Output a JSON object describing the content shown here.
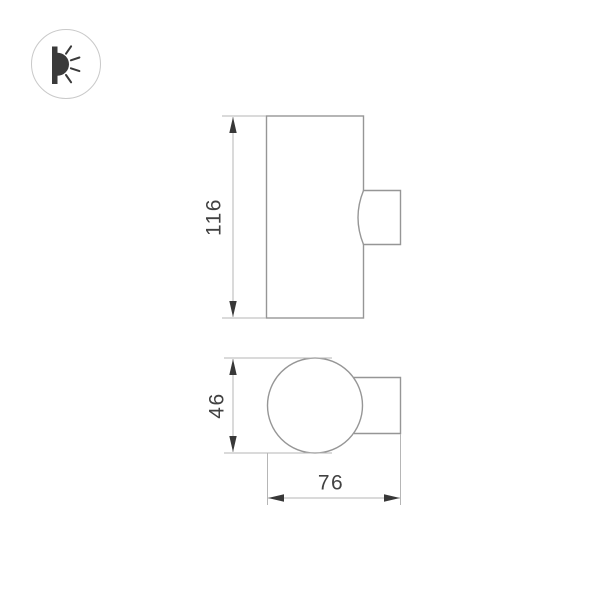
{
  "logo": {
    "icon": "wall-light-icon"
  },
  "drawing": {
    "type": "technical-dimension-drawing",
    "front_view": {
      "height_dimension": "116"
    },
    "top_view": {
      "diameter_dimension": "46",
      "depth_dimension": "76"
    }
  },
  "colors": {
    "background": "#ffffff",
    "shape_outline": "#969696",
    "dimension_line": "#b6b6b6",
    "arrow": "#383838",
    "dimension_text": "#424242",
    "logo_ring": "#c9c9c9",
    "logo_icon": "#3a3a3a"
  }
}
